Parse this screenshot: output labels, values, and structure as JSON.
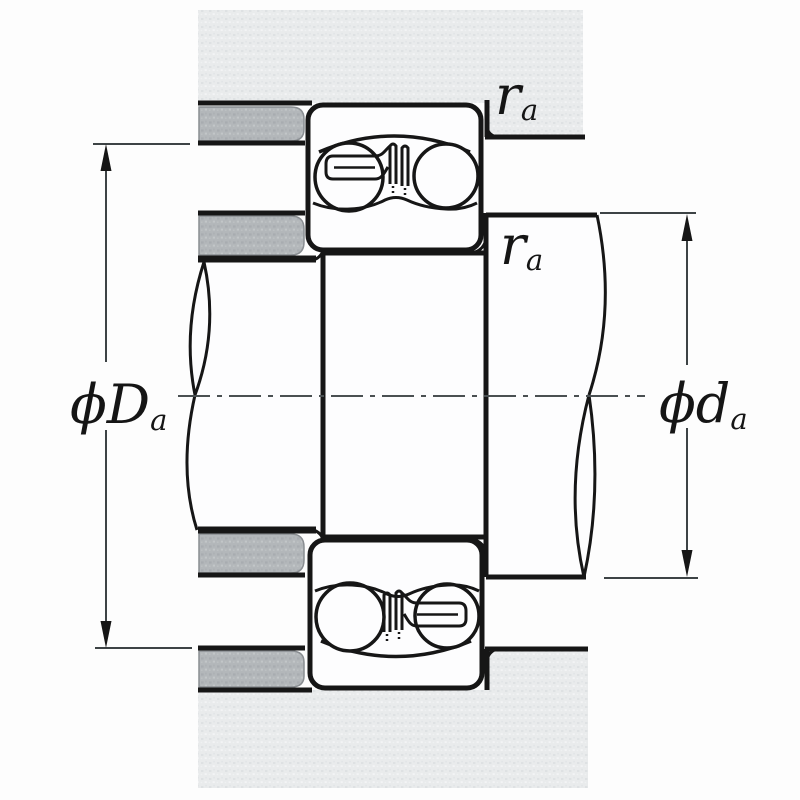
{
  "figure": {
    "kind": "bearing mounting cross-section drawing",
    "description": "Double-row self-aligning ball bearing seated in a housing on a stepped shaft; abutment diameters and fillet radii are dimensioned"
  },
  "labels": {
    "housing_abutment_diameter": {
      "phi_main": "ϕD",
      "sub": "a",
      "display": "ϕDa"
    },
    "shaft_abutment_diameter": {
      "phi_main": "ϕd",
      "sub": "a",
      "display": "ϕda"
    },
    "fillet_radius_top": {
      "main": "r",
      "sub": "a",
      "display": "ra"
    },
    "fillet_radius_middle": {
      "main": "r",
      "sub": "a",
      "display": "ra"
    }
  },
  "colors": {
    "background": "#fdfdfd",
    "line": "#161616",
    "dimension_line": "#3d4345",
    "centerline": "#4a5052",
    "housing_base": "#e9ebec",
    "housing_speckle_dark": "#dee1e3",
    "housing_speckle_light": "#f3f4f5",
    "spacer_base": "#b3b7ba",
    "spacer_speckle_dark": "#a8acb0",
    "spacer_speckle_light": "#c2c6c8",
    "part_white": "#fdfdfe",
    "label_ink": "#151515"
  }
}
